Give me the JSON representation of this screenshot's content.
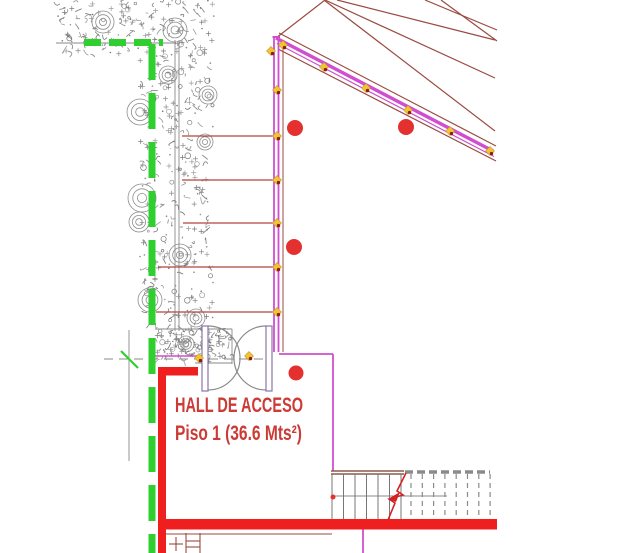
{
  "labels": {
    "hall_name": "HALL DE ACCESO",
    "hall_area": "Piso 1  (36.6 Mts²)"
  },
  "colors": {
    "magenta": "#cf4fcf",
    "brown": "#9a4b41",
    "tie_red": "#b5443a",
    "wall_red": "#f01f1f",
    "green": "#2fcf2f",
    "gray": "#8a8a8a",
    "stair_brown": "#8b5a4a",
    "break_red": "#d42222",
    "column_red": "#e53030",
    "marker_yellow": "#f2c335",
    "marker_red": "#8b1d12",
    "olive": "#b9a23a",
    "text_red": "#cc3b35",
    "door_jamb": "#8877aa"
  },
  "drawing": {
    "width": 628,
    "height": 553,
    "veg": {
      "regions": [
        {
          "x": 58,
          "y": 0,
          "w": 157,
          "h": 57,
          "d": 0.55
        },
        {
          "x": 140,
          "y": 55,
          "w": 73,
          "h": 275,
          "d": 0.42
        },
        {
          "x": 156,
          "y": 329,
          "w": 74,
          "h": 33,
          "d": 1.5
        }
      ],
      "rosettes": [
        [
          103,
          22,
          11
        ],
        [
          175,
          30,
          12
        ],
        [
          140,
          112,
          13
        ],
        [
          208,
          95,
          9
        ],
        [
          168,
          75,
          9
        ],
        [
          205,
          142,
          8
        ],
        [
          142,
          198,
          14
        ],
        [
          139,
          222,
          10
        ],
        [
          180,
          255,
          11
        ],
        [
          150,
          300,
          12
        ],
        [
          196,
          318,
          9
        ],
        [
          186,
          344,
          8
        ]
      ]
    },
    "lines": [
      {
        "x1": 56,
        "y1": 43,
        "x2": 176,
        "y2": 43,
        "w": 0.9,
        "c": "gray"
      },
      {
        "x1": 175,
        "y1": 40,
        "x2": 175,
        "y2": 331,
        "w": 0.9,
        "c": "gray"
      },
      {
        "x1": 179,
        "y1": 40,
        "x2": 179,
        "y2": 331,
        "w": 0.9,
        "c": "gray"
      },
      {
        "x1": 129,
        "y1": 330,
        "x2": 129,
        "y2": 461,
        "w": 0.9,
        "c": "gray"
      },
      {
        "x1": 104,
        "y1": 359,
        "x2": 268,
        "y2": 359,
        "w": 1,
        "c": "gray",
        "dash": "9 6"
      },
      {
        "x1": 155,
        "y1": 329,
        "x2": 232,
        "y2": 329,
        "w": 0.9,
        "c": "gray"
      },
      {
        "x1": 232,
        "y1": 329,
        "x2": 232,
        "y2": 364,
        "w": 0.9,
        "c": "gray"
      },
      {
        "x1": 195,
        "y1": 363,
        "x2": 232,
        "y2": 363,
        "w": 0.9,
        "c": "gray"
      },
      {
        "x1": 325,
        "y1": 0,
        "x2": 276,
        "y2": 38,
        "w": 1.2,
        "c": "brown"
      },
      {
        "x1": 337,
        "y1": 0,
        "x2": 495,
        "y2": 40,
        "w": 1.2,
        "c": "brown"
      },
      {
        "x1": 325,
        "y1": 0,
        "x2": 495,
        "y2": 78,
        "w": 1.2,
        "c": "brown"
      },
      {
        "x1": 324,
        "y1": 0,
        "x2": 495,
        "y2": 131,
        "w": 1.2,
        "c": "brown"
      },
      {
        "x1": 425,
        "y1": 0,
        "x2": 497,
        "y2": 30,
        "w": 1.2,
        "c": "brown"
      },
      {
        "x1": 441,
        "y1": 0,
        "x2": 497,
        "y2": 41,
        "w": 1.2,
        "c": "brown"
      },
      {
        "x1": 279,
        "y1": 33,
        "x2": 496,
        "y2": 146,
        "w": 1.2,
        "c": "brown"
      },
      {
        "x1": 278,
        "y1": 49,
        "x2": 496,
        "y2": 161,
        "w": 1.2,
        "c": "brown"
      },
      {
        "x1": 283,
        "y1": 45,
        "x2": 283,
        "y2": 352,
        "w": 1,
        "c": "brown"
      },
      {
        "x1": 161,
        "y1": 534,
        "x2": 332,
        "y2": 534,
        "w": 1,
        "c": "brown"
      },
      {
        "x1": 186,
        "y1": 533,
        "x2": 186,
        "y2": 553,
        "w": 1.1,
        "c": "brown"
      },
      {
        "x1": 200,
        "y1": 533,
        "x2": 200,
        "y2": 553,
        "w": 1.1,
        "c": "brown"
      },
      {
        "x1": 186,
        "y1": 541,
        "x2": 200,
        "y2": 541,
        "w": 1.1,
        "c": "brown"
      },
      {
        "x1": 186,
        "y1": 547,
        "x2": 200,
        "y2": 547,
        "w": 1.1,
        "c": "brown"
      },
      {
        "x1": 169,
        "y1": 544,
        "x2": 183,
        "y2": 544,
        "w": 1.1,
        "c": "brown"
      },
      {
        "x1": 176,
        "y1": 537,
        "x2": 176,
        "y2": 551,
        "w": 1.1,
        "c": "brown"
      },
      {
        "x1": 182,
        "y1": 136,
        "x2": 275,
        "y2": 136,
        "w": 1.3,
        "c": "tie_red"
      },
      {
        "x1": 182,
        "y1": 180,
        "x2": 275,
        "y2": 180,
        "w": 1.3,
        "c": "tie_red"
      },
      {
        "x1": 183,
        "y1": 223,
        "x2": 275,
        "y2": 223,
        "w": 1.3,
        "c": "tie_red"
      },
      {
        "x1": 158,
        "y1": 267,
        "x2": 275,
        "y2": 267,
        "w": 1.3,
        "c": "tie_red"
      },
      {
        "x1": 156,
        "y1": 312,
        "x2": 275,
        "y2": 312,
        "w": 1.3,
        "c": "tie_red"
      },
      {
        "x1": 274,
        "y1": 37,
        "x2": 274,
        "y2": 352,
        "w": 1.8,
        "c": "magenta"
      },
      {
        "x1": 278.5,
        "y1": 37,
        "x2": 278.5,
        "y2": 352,
        "w": 1.8,
        "c": "magenta"
      },
      {
        "x1": 272.5,
        "y1": 37,
        "x2": 280,
        "y2": 37,
        "w": 2,
        "c": "magenta"
      },
      {
        "x1": 276,
        "y1": 38,
        "x2": 493,
        "y2": 151,
        "w": 3.5,
        "c": "magenta"
      },
      {
        "x1": 277,
        "y1": 43.5,
        "x2": 494,
        "y2": 156.5,
        "w": 1.2,
        "c": "magenta"
      },
      {
        "x1": 279,
        "y1": 354,
        "x2": 333,
        "y2": 354,
        "w": 1.8,
        "c": "magenta"
      },
      {
        "x1": 333,
        "y1": 354,
        "x2": 333,
        "y2": 471,
        "w": 1.8,
        "c": "magenta"
      },
      {
        "x1": 363,
        "y1": 529,
        "x2": 363,
        "y2": 553,
        "w": 1.8,
        "c": "magenta"
      },
      {
        "x1": 155,
        "y1": 356,
        "x2": 207,
        "y2": 356,
        "w": 1.5,
        "c": "magenta"
      },
      {
        "x1": 152,
        "y1": 44,
        "x2": 152,
        "y2": 553,
        "w": 7,
        "c": "green",
        "dash": "36 13"
      },
      {
        "x1": 84,
        "y1": 42.5,
        "x2": 163,
        "y2": 42.5,
        "w": 7,
        "c": "green",
        "dash": "17 8"
      },
      {
        "x1": 121,
        "y1": 351,
        "x2": 138,
        "y2": 368,
        "w": 2.2,
        "c": "green"
      },
      {
        "x1": 331,
        "y1": 471,
        "x2": 404,
        "y2": 471,
        "w": 1.4,
        "c": "stair_brown"
      },
      {
        "x1": 331,
        "y1": 474,
        "x2": 404,
        "y2": 474,
        "w": 1.4,
        "c": "stair_brown"
      },
      {
        "x1": 405,
        "y1": 472,
        "x2": 490,
        "y2": 472,
        "w": 3.5,
        "c": "gray",
        "dash": "8 4"
      },
      {
        "x1": 332,
        "y1": 496,
        "x2": 447,
        "y2": 496,
        "w": 0.9,
        "c": "gray"
      },
      {
        "x1": 242,
        "y1": 528,
        "x2": 250,
        "y2": 522,
        "w": 2.5,
        "c": "olive"
      }
    ],
    "rects": [
      {
        "x": 158,
        "y": 368,
        "w": 8,
        "h": 185,
        "c": "wall_red"
      },
      {
        "x": 158,
        "y": 367,
        "w": 40,
        "h": 8.5,
        "c": "wall_red"
      },
      {
        "x": 160,
        "y": 519,
        "w": 337,
        "h": 10.5,
        "c": "wall_red"
      }
    ],
    "stairs": {
      "solid": {
        "x0": 332,
        "step": 11.5,
        "count": 7
      },
      "dashed": {
        "x0": 411,
        "step": 11.3,
        "count": 8
      },
      "y1": 474,
      "y2": 519,
      "break_path": "M406,473 L397,491 L403,495 L389,499 L395,503 L388,520",
      "arrow": "388,499 400,492 396,502"
    },
    "door": {
      "jambs": [
        [
          202,
          326,
          6,
          65
        ],
        [
          266,
          326,
          6,
          65
        ]
      ],
      "arcs": [
        "M208,326 A32,32 0 0 1 208,390",
        "M266,326 A32,32 0 0 0 266,390"
      ]
    },
    "circles": [
      [
        295,
        128,
        8
      ],
      [
        406,
        127,
        8
      ],
      [
        294,
        247,
        8
      ],
      [
        296,
        373,
        7.5
      ],
      [
        333,
        497,
        2.5
      ]
    ],
    "markers": [
      [
        271,
        51
      ],
      [
        277,
        90
      ],
      [
        277,
        136
      ],
      [
        277,
        180
      ],
      [
        277,
        223
      ],
      [
        277,
        267
      ],
      [
        277,
        312
      ],
      [
        283,
        45
      ],
      [
        324,
        67
      ],
      [
        366,
        88
      ],
      [
        408,
        110
      ],
      [
        450,
        131
      ],
      [
        490,
        151
      ],
      [
        199,
        358
      ],
      [
        249,
        356
      ]
    ]
  }
}
